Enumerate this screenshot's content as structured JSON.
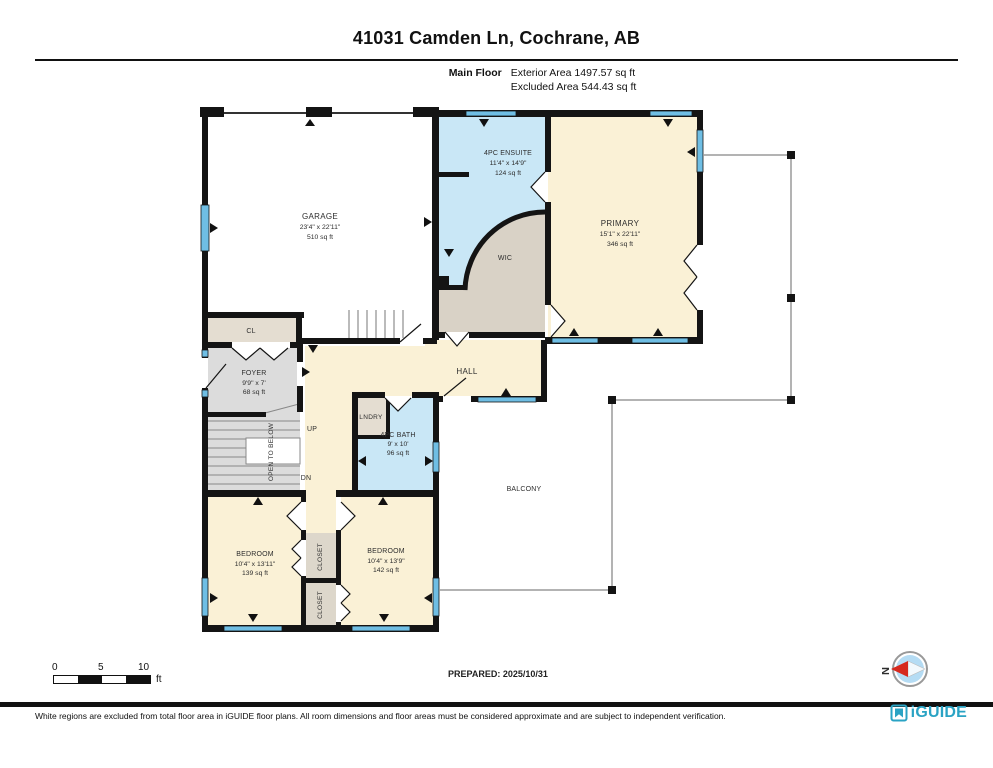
{
  "title": "41031 Camden Ln, Cochrane, AB",
  "header": {
    "floor_label": "Main Floor",
    "exterior_area": "Exterior Area 1497.57 sq ft",
    "excluded_area": "Excluded Area 544.43 sq ft"
  },
  "rooms": {
    "garage": {
      "name": "GARAGE",
      "dims": "23'4\" x 22'11\"",
      "area": "510 sq ft"
    },
    "ensuite": {
      "name": "4PC ENSUITE",
      "dims": "11'4\" x 14'9\"",
      "area": "124 sq ft"
    },
    "primary": {
      "name": "PRIMARY",
      "dims": "15'1\" x 22'11\"",
      "area": "346 sq ft"
    },
    "wic": {
      "name": "WIC"
    },
    "closet_entry": {
      "name": "CL"
    },
    "foyer": {
      "name": "FOYER",
      "dims": "9'9\" x 7'",
      "area": "68 sq ft"
    },
    "hall": {
      "name": "HALL"
    },
    "laundry": {
      "name": "LNDRY"
    },
    "bath": {
      "name": "4PC BATH",
      "dims": "9' x 10'",
      "area": "96 sq ft"
    },
    "balcony": {
      "name": "BALCONY"
    },
    "bedroom_left": {
      "name": "BEDROOM",
      "dims": "10'4\" x 13'11\"",
      "area": "139 sq ft"
    },
    "bedroom_right": {
      "name": "BEDROOM",
      "dims": "10'4\" x 13'9\"",
      "area": "142 sq ft"
    },
    "closet_upper": {
      "name": "CLOSET"
    },
    "closet_lower": {
      "name": "CLOSET"
    },
    "open_to_below": {
      "name": "OPEN TO BELOW"
    },
    "stairs_up": {
      "name": "UP"
    },
    "stairs_down": {
      "name": "DN"
    }
  },
  "scale_bar": {
    "tick_0": "0",
    "tick_5": "5",
    "tick_10": "10",
    "unit": "ft"
  },
  "prepared_label": "PREPARED: 2025/10/31",
  "compass": {
    "north": "N"
  },
  "footer": {
    "disclaimer": "White regions are excluded from total floor area in iGUIDE floor plans. All room dimensions and floor areas must be considered approximate and are subject to independent verification.",
    "brand": "iGUIDE"
  },
  "colors": {
    "wall": "#141414",
    "room_beige": "#FAF1D6",
    "room_blue": "#C9E7F6",
    "room_grey": "#DCDCDC",
    "room_tan": "#E4DDD1",
    "window_blue": "#6FBEE4",
    "brand_teal": "#2AA3C4",
    "compass_red": "#D6291E",
    "compass_blue": "#B5DCF4"
  }
}
